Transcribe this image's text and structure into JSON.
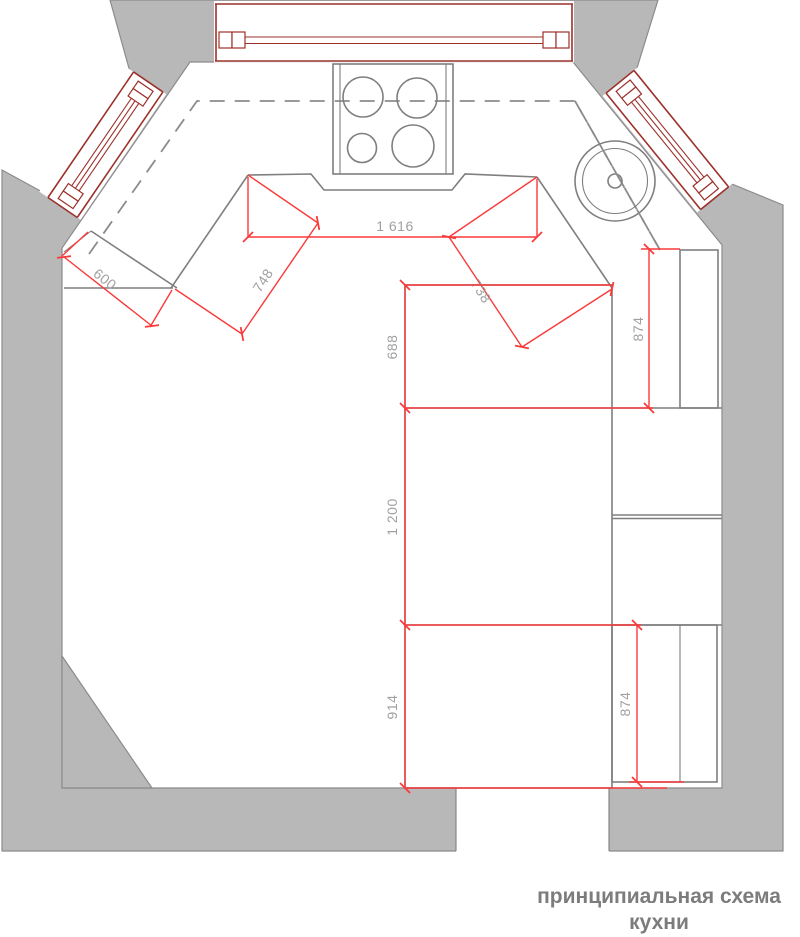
{
  "title": {
    "line1": "принципиальная схема",
    "line2": "кухни"
  },
  "dimensions": {
    "counter_width": {
      "label": "1 616"
    },
    "left_corner_cabinet": {
      "label": "748"
    },
    "right_corner_cabinet": {
      "label": "738"
    },
    "left_counter_depth": {
      "label": "600"
    },
    "table_top_section": {
      "label": "688"
    },
    "table_middle_section": {
      "label": "1 200"
    },
    "table_bottom_section": {
      "label": "914"
    },
    "right_cabinet_upper": {
      "label": "874"
    },
    "right_cabinet_lower": {
      "label": "874"
    }
  },
  "colors": {
    "wall_fill": "#b8b8b8",
    "wall_stroke": "#8c8c8c",
    "line_gray": "#7f7f7f",
    "dash_gray": "#8c8c8c",
    "win_red": "#9c312b",
    "dim_red": "#fa3a3a",
    "dim_text": "#a0a0a0",
    "title_gray": "#7c7c7c"
  }
}
